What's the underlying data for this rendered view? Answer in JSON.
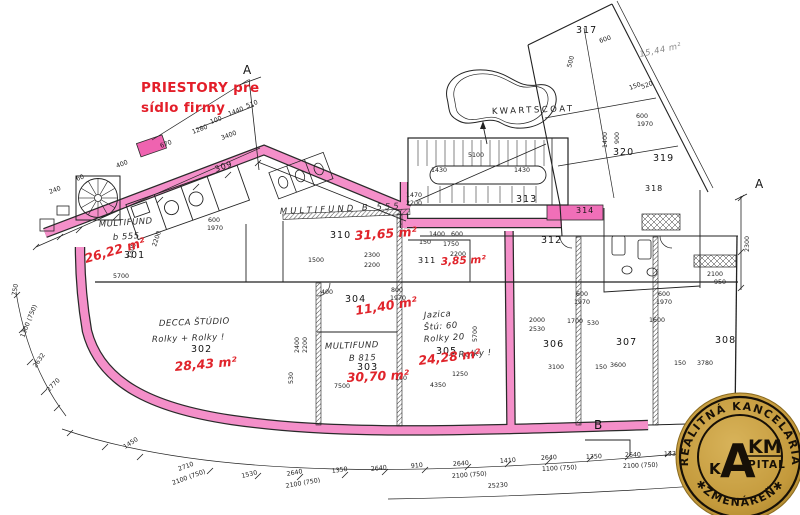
{
  "title": {
    "line1": "PRIESTORY pre",
    "line2": "sídlo firmy"
  },
  "pool": {
    "label": "KWARTSCOAT"
  },
  "seal": {
    "ring_top": "REALITNÁ KANCELÁRIA",
    "ring_bottom": "✱ZMENÁREŇ✱",
    "logo_k": "K",
    "logo_a": "A",
    "logo_km": "KM",
    "logo_pital": "PITAL"
  },
  "section_markers": [
    {
      "label": "A",
      "x": 243,
      "y": 74
    },
    {
      "label": "A",
      "x": 755,
      "y": 188
    },
    {
      "label": "B",
      "x": 594,
      "y": 429
    }
  ],
  "rooms": [
    {
      "number": "301",
      "x": 124,
      "y": 258
    },
    {
      "number": "302",
      "x": 191,
      "y": 352
    },
    {
      "number": "303",
      "x": 357,
      "y": 370
    },
    {
      "number": "304",
      "x": 345,
      "y": 302
    },
    {
      "number": "305",
      "x": 436,
      "y": 354
    },
    {
      "number": "306",
      "x": 543,
      "y": 347
    },
    {
      "number": "307",
      "x": 616,
      "y": 345
    },
    {
      "number": "308",
      "x": 715,
      "y": 343
    },
    {
      "number": "309",
      "x": 216,
      "y": 172,
      "rot": -20,
      "fs": 8
    },
    {
      "number": "310",
      "x": 330,
      "y": 238
    },
    {
      "number": "311",
      "x": 418,
      "y": 263,
      "fs": 8
    },
    {
      "number": "312",
      "x": 541,
      "y": 243
    },
    {
      "number": "313",
      "x": 516,
      "y": 202
    },
    {
      "number": "314",
      "x": 576,
      "y": 213,
      "fs": 8
    },
    {
      "number": "317",
      "x": 576,
      "y": 33
    },
    {
      "number": "318",
      "x": 645,
      "y": 191,
      "fs": 8
    },
    {
      "number": "319",
      "x": 653,
      "y": 161
    },
    {
      "number": "320",
      "x": 613,
      "y": 155
    }
  ],
  "red_areas": [
    {
      "t": "26,22 m²",
      "x": 86,
      "y": 263,
      "rot": -16
    },
    {
      "t": "31,65 m²",
      "x": 355,
      "y": 240,
      "rot": -4
    },
    {
      "t": "3,85 m²",
      "x": 441,
      "y": 265,
      "rot": -3,
      "fs": 10.5
    },
    {
      "t": "28,43 m²",
      "x": 175,
      "y": 371,
      "rot": -5
    },
    {
      "t": "11,40 m²",
      "x": 356,
      "y": 315,
      "rot": -9
    },
    {
      "t": "30,70 m²",
      "x": 347,
      "y": 382,
      "rot": -3
    },
    {
      "t": "24,28 m²",
      "x": 419,
      "y": 365,
      "rot": -7
    }
  ],
  "pencil_notes": [
    {
      "t": "MULTIFUND",
      "x": 99,
      "y": 227,
      "rot": -4
    },
    {
      "t": "b 555",
      "x": 113,
      "y": 240,
      "rot": -4
    },
    {
      "t": "MULTIFUND  B  555",
      "x": 280,
      "y": 214,
      "rot": -2.5,
      "ls": 3
    },
    {
      "t": "DECCA ŠTÚDIO",
      "x": 159,
      "y": 326,
      "rot": -2
    },
    {
      "t": "Rolky + Rolky !",
      "x": 152,
      "y": 342,
      "rot": -2
    },
    {
      "t": "MULTIFUND",
      "x": 325,
      "y": 349,
      "rot": -2
    },
    {
      "t": "B 815",
      "x": 349,
      "y": 361,
      "rot": -2
    },
    {
      "t": "Jazica",
      "x": 424,
      "y": 318,
      "rot": -4
    },
    {
      "t": "Štú: 60",
      "x": 424,
      "y": 330,
      "rot": -4
    },
    {
      "t": "Rolky 20",
      "x": 424,
      "y": 342,
      "rot": -4
    },
    {
      "t": "+ Rolky !",
      "x": 448,
      "y": 358,
      "rot": -4
    },
    {
      "t": "15,44 m²",
      "x": 640,
      "y": 57,
      "rot": -12,
      "faint": true
    }
  ],
  "dims": [
    {
      "t": "240",
      "x": 50,
      "y": 194,
      "r": -21
    },
    {
      "t": "60",
      "x": 77,
      "y": 181,
      "r": -21
    },
    {
      "t": "400",
      "x": 117,
      "y": 168,
      "r": -21
    },
    {
      "t": "670",
      "x": 161,
      "y": 148,
      "r": -21
    },
    {
      "t": "1280",
      "x": 193,
      "y": 134,
      "r": -21
    },
    {
      "t": "3400",
      "x": 222,
      "y": 140,
      "r": -21
    },
    {
      "t": "100",
      "x": 211,
      "y": 124,
      "r": -21
    },
    {
      "t": "1440",
      "x": 229,
      "y": 116,
      "r": -21
    },
    {
      "t": "510",
      "x": 247,
      "y": 108,
      "r": -21
    },
    {
      "t": "750",
      "x": 16,
      "y": 296,
      "r": -80
    },
    {
      "t": "1300 (750)",
      "x": 24,
      "y": 338,
      "r": -68
    },
    {
      "t": "2632",
      "x": 36,
      "y": 368,
      "r": -55
    },
    {
      "t": "2770",
      "x": 49,
      "y": 392,
      "r": -45
    },
    {
      "t": "1450",
      "x": 125,
      "y": 449,
      "r": -33
    },
    {
      "t": "2710",
      "x": 179,
      "y": 471,
      "r": -20
    },
    {
      "t": "2100 (750)",
      "x": 173,
      "y": 485,
      "r": -20
    },
    {
      "t": "1530",
      "x": 242,
      "y": 478,
      "r": -13
    },
    {
      "t": "2640",
      "x": 287,
      "y": 476,
      "r": -10
    },
    {
      "t": "2100 (750)",
      "x": 286,
      "y": 488,
      "r": -10
    },
    {
      "t": "1350",
      "x": 332,
      "y": 473,
      "r": -8
    },
    {
      "t": "2640",
      "x": 371,
      "y": 471,
      "r": -6
    },
    {
      "t": "910",
      "x": 411,
      "y": 468,
      "r": -5
    },
    {
      "t": "2640",
      "x": 453,
      "y": 466,
      "r": -4
    },
    {
      "t": "2100 (750)",
      "x": 452,
      "y": 478,
      "r": -4
    },
    {
      "t": "1410",
      "x": 500,
      "y": 463,
      "r": -4
    },
    {
      "t": "2640",
      "x": 541,
      "y": 460,
      "r": -3
    },
    {
      "t": "1100 (750)",
      "x": 542,
      "y": 471,
      "r": -3
    },
    {
      "t": "1350",
      "x": 586,
      "y": 459,
      "r": -3
    },
    {
      "t": "2640",
      "x": 625,
      "y": 457,
      "r": -2
    },
    {
      "t": "2100 (750)",
      "x": 623,
      "y": 468,
      "r": -2
    },
    {
      "t": "1330",
      "x": 664,
      "y": 456,
      "r": -2
    },
    {
      "t": "25230",
      "x": 488,
      "y": 488,
      "r": -4
    },
    {
      "t": "2300",
      "x": 749,
      "y": 252,
      "r": -90
    },
    {
      "t": "2100",
      "x": 707,
      "y": 276
    },
    {
      "t": "950",
      "x": 714,
      "y": 284
    },
    {
      "t": "1500",
      "x": 308,
      "y": 262
    },
    {
      "t": "2300",
      "x": 364,
      "y": 257
    },
    {
      "t": "2200",
      "x": 364,
      "y": 267
    },
    {
      "t": "1400",
      "x": 429,
      "y": 236
    },
    {
      "t": "600",
      "x": 451,
      "y": 236
    },
    {
      "t": "1750",
      "x": 443,
      "y": 246
    },
    {
      "t": "2200",
      "x": 450,
      "y": 256
    },
    {
      "t": "150",
      "x": 419,
      "y": 244
    },
    {
      "t": "400",
      "x": 321,
      "y": 294
    },
    {
      "t": "800",
      "x": 391,
      "y": 292
    },
    {
      "t": "1970",
      "x": 390,
      "y": 300
    },
    {
      "t": "5700",
      "x": 113,
      "y": 278
    },
    {
      "t": "2200",
      "x": 156,
      "y": 247,
      "r": -72
    },
    {
      "t": "1300",
      "x": 131,
      "y": 259,
      "r": -72
    },
    {
      "t": "600",
      "x": 208,
      "y": 222
    },
    {
      "t": "1970",
      "x": 207,
      "y": 230
    },
    {
      "t": "2400",
      "x": 299,
      "y": 353,
      "r": -90
    },
    {
      "t": "2200",
      "x": 307,
      "y": 353,
      "r": -90
    },
    {
      "t": "7500",
      "x": 334,
      "y": 388
    },
    {
      "t": "530",
      "x": 293,
      "y": 384,
      "r": -90
    },
    {
      "t": "160",
      "x": 395,
      "y": 380
    },
    {
      "t": "5700",
      "x": 477,
      "y": 342,
      "r": -90
    },
    {
      "t": "1250",
      "x": 452,
      "y": 376
    },
    {
      "t": "4350",
      "x": 430,
      "y": 387
    },
    {
      "t": "2000",
      "x": 529,
      "y": 322
    },
    {
      "t": "2530",
      "x": 529,
      "y": 331
    },
    {
      "t": "1700",
      "x": 567,
      "y": 323
    },
    {
      "t": "530",
      "x": 587,
      "y": 325
    },
    {
      "t": "1600",
      "x": 649,
      "y": 322
    },
    {
      "t": "3100",
      "x": 548,
      "y": 369
    },
    {
      "t": "150",
      "x": 595,
      "y": 369
    },
    {
      "t": "3600",
      "x": 610,
      "y": 367
    },
    {
      "t": "150",
      "x": 674,
      "y": 365
    },
    {
      "t": "3780",
      "x": 697,
      "y": 365
    },
    {
      "t": "600",
      "x": 576,
      "y": 296
    },
    {
      "t": "1970",
      "x": 574,
      "y": 304
    },
    {
      "t": "600",
      "x": 658,
      "y": 296
    },
    {
      "t": "1970",
      "x": 656,
      "y": 304
    },
    {
      "t": "5100",
      "x": 468,
      "y": 157
    },
    {
      "t": "1430",
      "x": 431,
      "y": 172
    },
    {
      "t": "1430",
      "x": 514,
      "y": 172
    },
    {
      "t": "1470",
      "x": 406,
      "y": 197
    },
    {
      "t": "2200",
      "x": 406,
      "y": 205
    },
    {
      "t": "600",
      "x": 600,
      "y": 43,
      "r": -18
    },
    {
      "t": "500",
      "x": 571,
      "y": 68,
      "r": -75
    },
    {
      "t": "600",
      "x": 636,
      "y": 118
    },
    {
      "t": "1970",
      "x": 637,
      "y": 126
    },
    {
      "t": "1400",
      "x": 607,
      "y": 148,
      "r": -90
    },
    {
      "t": "900",
      "x": 619,
      "y": 144,
      "r": -90
    },
    {
      "t": "150",
      "x": 630,
      "y": 90,
      "r": -20
    },
    {
      "t": "520",
      "x": 642,
      "y": 89,
      "r": -20
    }
  ]
}
